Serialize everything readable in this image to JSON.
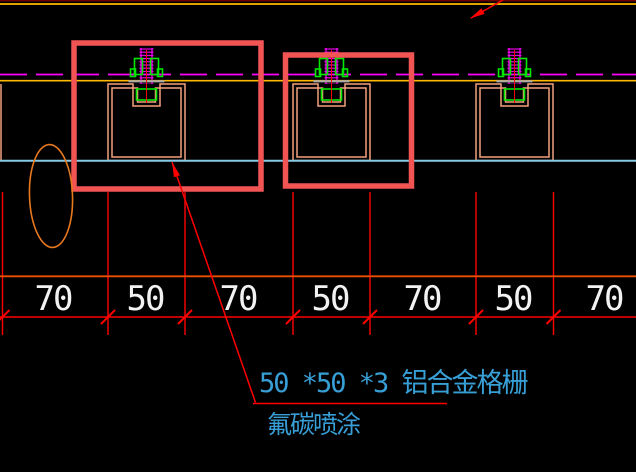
{
  "drawing": {
    "kind": "CAD detail - aluminum grille ceiling section",
    "background": "#000000"
  },
  "colors": {
    "background": "#000000",
    "top_border_dark_red": "#6B0000",
    "datum_gold": "#FFB900",
    "centerline_magenta": "#FF00FF",
    "dimension_red": "#FF0000",
    "band_orange": "#E85200",
    "channel_salmon": "#F2A17C",
    "highlight_box_red": "#F25454",
    "revision_cloud_orange": "#E8781E",
    "fastener_green": "#00E800",
    "plate_gray": "#A8A8A8",
    "ceiling_line_cyan": "#86CBE8",
    "dimension_text_white": "#F2F2F2",
    "note_text_cyan": "#379FD6"
  },
  "dimension_row": {
    "labels": [
      "70",
      "50",
      "70",
      "50",
      "70",
      "50",
      "70"
    ]
  },
  "callouts": {
    "grille_note_line1": "50 *50 *3 铝合金格栅",
    "grille_note_line2": "氟碳喷涂"
  }
}
